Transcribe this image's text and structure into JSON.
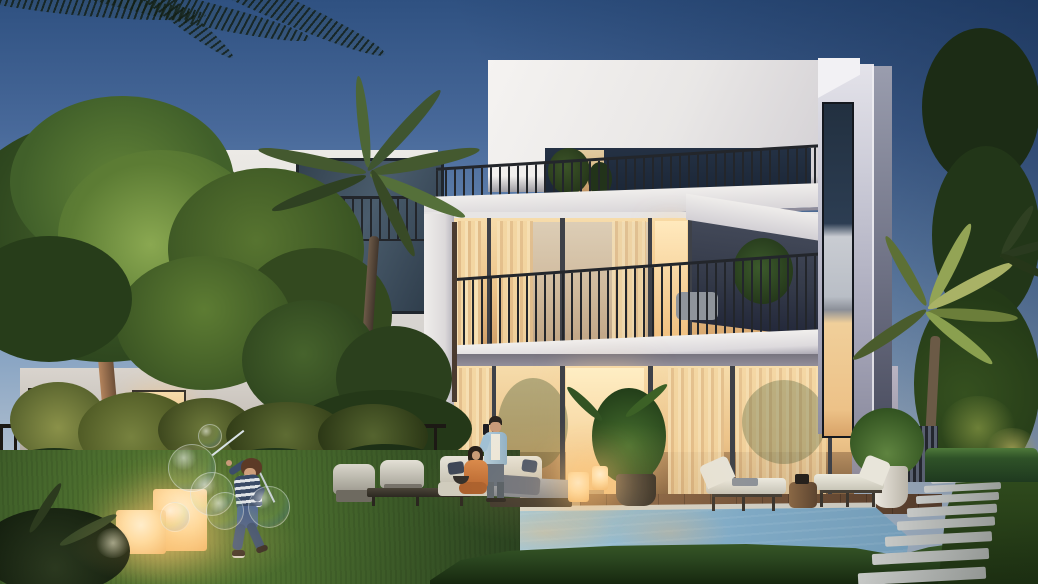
{
  "meta": {
    "kind": "architectural-rendering",
    "time_of_day": "dusk",
    "width_px": 1038,
    "height_px": 584
  },
  "scene": {
    "description": "Twilight exterior rendering of a modern white three-storey villa with warm-lit floor-to-ceiling glazing, rooftop terrace and balconies with black metal railings, a second villa at left behind a large up-lit tree, palm trees, landscaped garden with hedges and dark picket fence, a swimming pool with stone coping, wooden deck, lounge furniture, glowing cube lanterns, a stepping-stone path at right, a man taking a photo beside a seated woman, and a child on the lawn playing with giant soap bubbles",
    "buildings": [
      {
        "id": "main-villa",
        "storeys": 3,
        "features": [
          "penthouse box",
          "roof terrace railing",
          "second-floor balcony",
          "full-height warm-lit glass walls",
          "narrow vertical window tower"
        ]
      },
      {
        "id": "left-villa",
        "features": [
          "roof terrace railing",
          "dark glazing",
          "warm-lit lower window"
        ]
      }
    ],
    "people": [
      {
        "id": "man",
        "pose": "standing by pool holding phone up"
      },
      {
        "id": "woman",
        "pose": "seated on outdoor sofa, orange outfit"
      },
      {
        "id": "child",
        "pose": "running on lawn waving bubble wands"
      }
    ],
    "props": {
      "bubbles": 6,
      "glow_cubes": 4,
      "chaise_lounges": 2,
      "armchairs": 2,
      "stepping_stones": 11,
      "potted_plants": 4
    },
    "landscape": [
      "large up-lit tree",
      "palms",
      "hedge row",
      "lawn",
      "pool",
      "wood deck",
      "stepping-stone path"
    ]
  },
  "palette": {
    "sky-top": "#2f5181",
    "sky-mid": "#6b8cb5",
    "sky-low": "#b3c1cf",
    "villa-white": "#f0eeec",
    "villa-shadow": "#b7b4c0",
    "wing-front": "#c7c7d4",
    "wing-side": "#7c7f92",
    "glass-dark": "#2c3b4d",
    "warm-light": "#f6d9a4",
    "warm-deep": "#d9a368",
    "frame-dark": "#3e4148",
    "railing": "#23262b",
    "tree-dark": "#24371e",
    "tree-mid": "#3d5a2c",
    "tree-lit": "#7c9a4e",
    "grass-dark": "#203518",
    "grass-mid": "#3c5c28",
    "grass-lit": "#5f8438",
    "pool-light": "#c2e2ee",
    "pool-deep": "#6f98b4",
    "deck": "#8a6647",
    "coping": "#e8e4da",
    "stone": "#b4b6b6",
    "cushion": "#e6e3d8",
    "lamp-glow": "#ffdfa8",
    "skin": "#c99a79",
    "shirt-blue": "#9fc0d6",
    "dress-orange": "#c9763a",
    "stripe-navy": "#394a66"
  }
}
